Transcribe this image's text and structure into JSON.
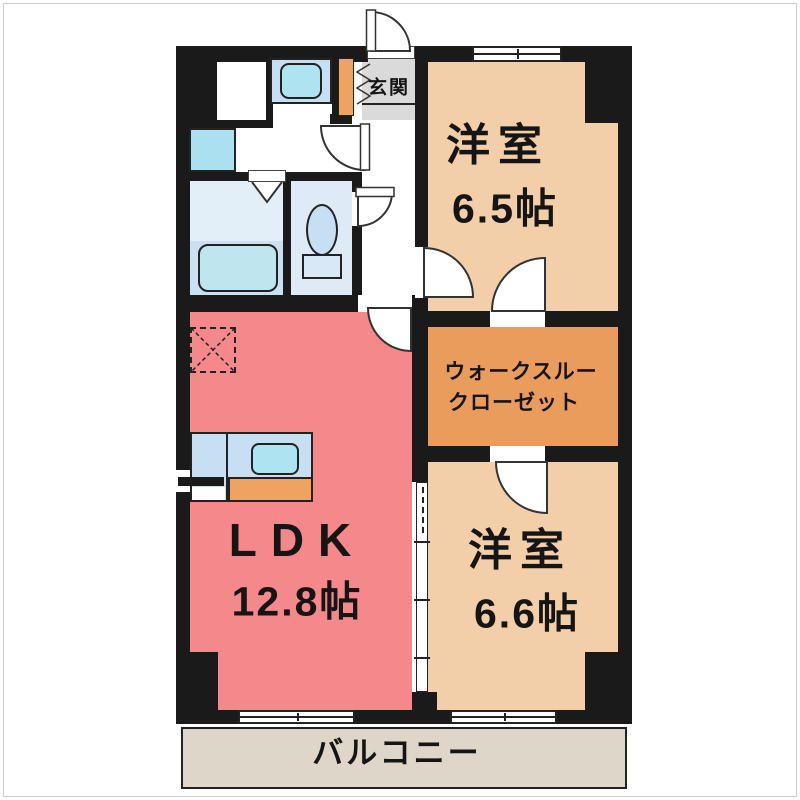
{
  "plan_title": "2LDK apartment floor plan",
  "rooms": {
    "entrance": {
      "label": "玄関"
    },
    "bedroom1": {
      "label": "洋室",
      "size": "6.5帖"
    },
    "closet": {
      "line1": "ウォークスルー",
      "line2": "クローゼット"
    },
    "bedroom2": {
      "label": "洋室",
      "size": "6.6帖"
    },
    "ldk": {
      "label": "LDK",
      "size": "12.8帖"
    },
    "balcony": {
      "label": "バルコニー"
    }
  },
  "colors": {
    "wall": "#1a1a1a",
    "ldk": "#F5888B",
    "bedroom": "#F3CFA9",
    "closet": "#EA9C5D",
    "entrance": "#DADADA",
    "balcony": "#DED6C8",
    "bath_upper": "#E3EFF8",
    "bath_lower": "#CBE0F2",
    "toilet_room": "#DEEBF7",
    "fixture_blue": "#C6DFF2",
    "sink_cyan": "#AEE4F2",
    "tub_cyan": "#BFE6EE",
    "cabinet_orange": "#F0A261"
  },
  "fixtures": [
    "bathtub",
    "toilet",
    "washbasin",
    "washing-machine-pan",
    "kitchen-counter",
    "kitchen-sink",
    "gas-stove",
    "shoe-cabinet",
    "refrigerator-space",
    "entrance-door",
    "hinged-door",
    "folding-bath-door",
    "sliding-door",
    "window"
  ]
}
